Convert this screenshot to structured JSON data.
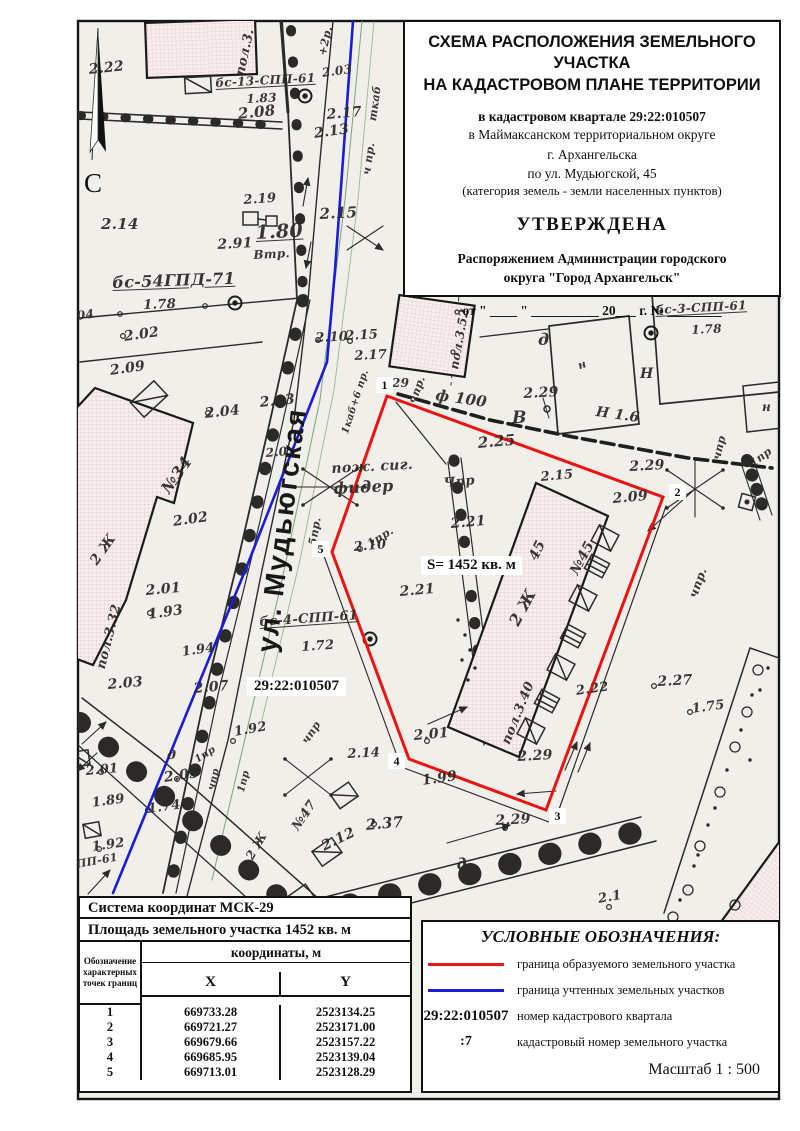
{
  "title_block": {
    "line1": "СХЕМА РАСПОЛОЖЕНИЯ ЗЕМЕЛЬНОГО УЧАСТКА",
    "line2": "НА КАДАСТРОВОМ ПЛАНЕ ТЕРРИТОРИИ",
    "quarter": "в кадастровом квартале 29:22:010507",
    "district": "в Маймаксанском территориальном округе",
    "city": "г. Архангельска",
    "street": "по ул. Мудьюгской, 45",
    "category": "(категория земель - земли населенных пунктов)",
    "approved": "УТВЕРЖДЕНА",
    "by_line1": "Распоряжением Администрации городского",
    "by_line2": "округа \"Город Архангельск\"",
    "date_line": "от \" ____ \" __________ 20___ г. № ________"
  },
  "map": {
    "north_label": "С",
    "street_name": "ул. Мудьюгская",
    "area_label": "S= 1452 кв. м",
    "quarter_label": "29:22:010507",
    "colors": {
      "parcel_boundary": "#ee1313",
      "cadastre_boundary": "#1b1bd8"
    },
    "red_boundary_points": "387,396 663,497 546,810 409,759 332,552",
    "blue_boundary_points": "353,21 335,270 327,362 247,566 113,893",
    "boundary_point_labels": [
      {
        "n": "1",
        "x": 376,
        "y": 377
      },
      {
        "n": "2",
        "x": 669,
        "y": 484
      },
      {
        "n": "3",
        "x": 549,
        "y": 808
      },
      {
        "n": "4",
        "x": 388,
        "y": 753
      },
      {
        "n": "5",
        "x": 312,
        "y": 541
      }
    ],
    "annotations": [
      {
        "t": "2.22",
        "x": 88,
        "y": 62,
        "r": -6,
        "s": 14
      },
      {
        "t": "бс-13-СПП-61",
        "x": 215,
        "y": 76,
        "r": -3,
        "s": 12,
        "u": 1
      },
      {
        "t": "1.83",
        "x": 246,
        "y": 92,
        "r": -3,
        "s": 12
      },
      {
        "t": "2.08",
        "x": 237,
        "y": 105,
        "r": -6,
        "s": 15
      },
      {
        "t": "пол.3.",
        "x": 233,
        "y": 74,
        "r": -78,
        "s": 13
      },
      {
        "t": "+2р.",
        "x": 316,
        "y": 54,
        "r": -78,
        "s": 11
      },
      {
        "t": "2.03",
        "x": 321,
        "y": 66,
        "r": -8,
        "s": 12
      },
      {
        "t": "ткаб",
        "x": 366,
        "y": 120,
        "r": -82,
        "s": 11
      },
      {
        "t": "2.17",
        "x": 326,
        "y": 107,
        "r": -5,
        "s": 14
      },
      {
        "t": "2.13",
        "x": 313,
        "y": 126,
        "r": -8,
        "s": 14
      },
      {
        "t": "ч пр.",
        "x": 360,
        "y": 174,
        "r": -82,
        "s": 11
      },
      {
        "t": "2.19",
        "x": 243,
        "y": 193,
        "r": -4,
        "s": 13
      },
      {
        "t": "2.15",
        "x": 319,
        "y": 205,
        "r": -3,
        "s": 15
      },
      {
        "t": "2.14",
        "x": 101,
        "y": 215,
        "r": 0,
        "s": 15
      },
      {
        "t": "2.91",
        "x": 217,
        "y": 237,
        "r": -3,
        "s": 14
      },
      {
        "t": "1.80",
        "x": 255,
        "y": 222,
        "r": -3,
        "s": 19,
        "u": 1
      },
      {
        "t": "Втр.",
        "x": 253,
        "y": 248,
        "r": -3,
        "s": 12
      },
      {
        "t": "бс-54ГПД-71",
        "x": 112,
        "y": 273,
        "r": -2,
        "s": 16,
        "u": 1
      },
      {
        "t": "1.78",
        "x": 143,
        "y": 298,
        "r": -2,
        "s": 13
      },
      {
        "t": "2.02",
        "x": 123,
        "y": 329,
        "r": -8,
        "s": 14
      },
      {
        "t": "2.09",
        "x": 109,
        "y": 363,
        "r": -8,
        "s": 14
      },
      {
        "t": "04",
        "x": 76,
        "y": 309,
        "r": -8,
        "s": 12
      },
      {
        "t": "2.04",
        "x": 204,
        "y": 406,
        "r": -6,
        "s": 14
      },
      {
        "t": "2.03",
        "x": 259,
        "y": 395,
        "r": -6,
        "s": 14
      },
      {
        "t": "2.10",
        "x": 315,
        "y": 331,
        "r": -3,
        "s": 13
      },
      {
        "t": "2.15",
        "x": 345,
        "y": 329,
        "r": -3,
        "s": 13
      },
      {
        "t": "2.17",
        "x": 354,
        "y": 349,
        "r": -3,
        "s": 13
      },
      {
        "t": "пол.3.52",
        "x": 447,
        "y": 368,
        "r": -80,
        "s": 12
      },
      {
        "t": "д",
        "x": 538,
        "y": 330,
        "r": 0,
        "s": 16
      },
      {
        "t": "н",
        "x": 576,
        "y": 360,
        "r": -20,
        "s": 11
      },
      {
        "t": "Н",
        "x": 640,
        "y": 366,
        "r": 0,
        "s": 14
      },
      {
        "t": "н",
        "x": 720,
        "y": 250,
        "r": 0,
        "s": 13
      },
      {
        "t": "н",
        "x": 762,
        "y": 400,
        "r": 0,
        "s": 12
      },
      {
        "t": "бс-3-СПП-61",
        "x": 655,
        "y": 303,
        "r": -3,
        "s": 12,
        "u": 1
      },
      {
        "t": "1.78",
        "x": 691,
        "y": 323,
        "r": -3,
        "s": 12
      },
      {
        "t": "ф 100",
        "x": 437,
        "y": 386,
        "r": 8,
        "s": 15
      },
      {
        "t": "2.29",
        "x": 523,
        "y": 386,
        "r": -3,
        "s": 14
      },
      {
        "t": "Н 1.6",
        "x": 597,
        "y": 404,
        "r": 8,
        "s": 14
      },
      {
        "t": "В",
        "x": 512,
        "y": 408,
        "r": 0,
        "s": 17
      },
      {
        "t": "2.25",
        "x": 477,
        "y": 434,
        "r": -5,
        "s": 15
      },
      {
        "t": "29",
        "x": 392,
        "y": 376,
        "r": 0,
        "s": 12
      },
      {
        "t": "чпр.",
        "x": 406,
        "y": 401,
        "r": -70,
        "s": 11
      },
      {
        "t": "2.29",
        "x": 629,
        "y": 459,
        "r": -3,
        "s": 14
      },
      {
        "t": "2.09",
        "x": 612,
        "y": 491,
        "r": -5,
        "s": 14
      },
      {
        "t": "чпр",
        "x": 710,
        "y": 458,
        "r": -76,
        "s": 11
      },
      {
        "t": "1пр",
        "x": 747,
        "y": 459,
        "r": -36,
        "s": 11
      },
      {
        "t": "2.15",
        "x": 540,
        "y": 470,
        "r": -5,
        "s": 13
      },
      {
        "t": "Чпр",
        "x": 443,
        "y": 476,
        "r": -5,
        "s": 13
      },
      {
        "t": "пож. сиг.",
        "x": 331,
        "y": 461,
        "r": -3,
        "s": 14
      },
      {
        "t": "фидер",
        "x": 333,
        "y": 479,
        "r": -3,
        "s": 16
      },
      {
        "t": "1пр.",
        "x": 365,
        "y": 539,
        "r": -32,
        "s": 11
      },
      {
        "t": "5пр.",
        "x": 306,
        "y": 544,
        "r": -80,
        "s": 11
      },
      {
        "t": "2.10",
        "x": 353,
        "y": 540,
        "r": -5,
        "s": 13
      },
      {
        "t": "2.21",
        "x": 450,
        "y": 516,
        "r": -5,
        "s": 14
      },
      {
        "t": "2.21",
        "x": 399,
        "y": 584,
        "r": -5,
        "s": 14
      },
      {
        "t": "45",
        "x": 526,
        "y": 556,
        "r": -64,
        "s": 14
      },
      {
        "t": "№45",
        "x": 567,
        "y": 570,
        "r": -62,
        "s": 14
      },
      {
        "t": "2 Ж",
        "x": 505,
        "y": 620,
        "r": -62,
        "s": 16
      },
      {
        "t": "пол.3.40",
        "x": 499,
        "y": 741,
        "r": -68,
        "s": 13
      },
      {
        "t": "2.01",
        "x": 413,
        "y": 728,
        "r": -5,
        "s": 14
      },
      {
        "t": "2.29",
        "x": 517,
        "y": 749,
        "r": -3,
        "s": 14
      },
      {
        "t": "1.99",
        "x": 421,
        "y": 773,
        "r": -8,
        "s": 14
      },
      {
        "t": "2.29",
        "x": 495,
        "y": 813,
        "r": -3,
        "s": 14
      },
      {
        "t": "2.14",
        "x": 347,
        "y": 747,
        "r": -3,
        "s": 13
      },
      {
        "t": "2.22",
        "x": 575,
        "y": 684,
        "r": -8,
        "s": 13
      },
      {
        "t": "2.27",
        "x": 657,
        "y": 674,
        "r": -3,
        "s": 14
      },
      {
        "t": "1.75",
        "x": 691,
        "y": 702,
        "r": -8,
        "s": 13
      },
      {
        "t": "чпр.",
        "x": 686,
        "y": 595,
        "r": -70,
        "s": 12
      },
      {
        "t": "пол.3.32",
        "x": 94,
        "y": 667,
        "r": -76,
        "s": 13
      },
      {
        "t": "2.01",
        "x": 145,
        "y": 583,
        "r": -5,
        "s": 14
      },
      {
        "t": "1.93",
        "x": 147,
        "y": 607,
        "r": -8,
        "s": 14
      },
      {
        "t": "1.94",
        "x": 181,
        "y": 645,
        "r": -8,
        "s": 13
      },
      {
        "t": "2.07",
        "x": 193,
        "y": 681,
        "r": -5,
        "s": 14
      },
      {
        "t": "2.03",
        "x": 107,
        "y": 677,
        "r": -5,
        "s": 14
      },
      {
        "t": "бс-4-СПП-61",
        "x": 259,
        "y": 615,
        "r": -4,
        "s": 13,
        "u": 1
      },
      {
        "t": "1.72",
        "x": 301,
        "y": 640,
        "r": -4,
        "s": 13
      },
      {
        "t": "1.92",
        "x": 233,
        "y": 725,
        "r": -10,
        "s": 13
      },
      {
        "t": "1пр",
        "x": 193,
        "y": 756,
        "r": -32,
        "s": 10
      },
      {
        "t": "чпр",
        "x": 206,
        "y": 789,
        "r": -76,
        "s": 10
      },
      {
        "t": "1пр",
        "x": 236,
        "y": 791,
        "r": -76,
        "s": 10
      },
      {
        "t": "чпр",
        "x": 299,
        "y": 739,
        "r": -56,
        "s": 11
      },
      {
        "t": "д",
        "x": 167,
        "y": 748,
        "r": 0,
        "s": 13
      },
      {
        "t": "2.05",
        "x": 163,
        "y": 770,
        "r": -8,
        "s": 14
      },
      {
        "t": "2.01",
        "x": 85,
        "y": 764,
        "r": -5,
        "s": 13
      },
      {
        "t": "1.89",
        "x": 91,
        "y": 796,
        "r": -8,
        "s": 13
      },
      {
        "t": "1.74",
        "x": 147,
        "y": 802,
        "r": -8,
        "s": 13
      },
      {
        "t": "1.92",
        "x": 91,
        "y": 840,
        "r": -8,
        "s": 13
      },
      {
        "t": "ПП-61",
        "x": 75,
        "y": 858,
        "r": -10,
        "s": 11
      },
      {
        "t": "№47",
        "x": 289,
        "y": 825,
        "r": -56,
        "s": 13
      },
      {
        "t": "2 Ж",
        "x": 243,
        "y": 855,
        "r": -60,
        "s": 12
      },
      {
        "t": "2.37",
        "x": 365,
        "y": 816,
        "r": -5,
        "s": 15
      },
      {
        "t": "2.12",
        "x": 319,
        "y": 840,
        "r": -26,
        "s": 14
      },
      {
        "t": "д",
        "x": 455,
        "y": 856,
        "r": -10,
        "s": 15
      },
      {
        "t": "2.1",
        "x": 597,
        "y": 892,
        "r": -10,
        "s": 13
      },
      {
        "t": "№34",
        "x": 157,
        "y": 486,
        "r": -55,
        "s": 16
      },
      {
        "t": "2 Ж",
        "x": 87,
        "y": 559,
        "r": -55,
        "s": 14
      },
      {
        "t": "2.02",
        "x": 172,
        "y": 514,
        "r": -8,
        "s": 14
      },
      {
        "t": "1каб+6 пр.",
        "x": 340,
        "y": 432,
        "r": -72,
        "s": 10
      },
      {
        "t": "2.0",
        "x": 265,
        "y": 446,
        "r": -5,
        "s": 12
      }
    ]
  },
  "coords_table": {
    "system_label": "Система координат МСК-29",
    "area_label": "Площадь земельного участка 1452 кв. м",
    "col_designation": "Обозначение характерных точек границ",
    "col_coords": "координаты, м",
    "col_x": "X",
    "col_y": "Y",
    "rows": [
      [
        "1",
        "669733.28",
        "2523134.25"
      ],
      [
        "2",
        "669721.27",
        "2523171.00"
      ],
      [
        "3",
        "669679.66",
        "2523157.22"
      ],
      [
        "4",
        "669685.95",
        "2523139.04"
      ],
      [
        "5",
        "669713.01",
        "2523128.29"
      ]
    ]
  },
  "legend": {
    "title": "УСЛОВНЫЕ ОБОЗНАЧЕНИЯ:",
    "items": [
      {
        "symbol": "red-line",
        "label": "граница образуемого земельного участка"
      },
      {
        "symbol": "blue-line",
        "label": "граница учтенных земельных участков"
      },
      {
        "symbol": "29:22:010507",
        "label": "номер кадастрового квартала"
      },
      {
        "symbol": ":7",
        "label": "кадастровый номер земельного участка"
      }
    ],
    "scale_label": "Масштаб  1 : 500"
  }
}
